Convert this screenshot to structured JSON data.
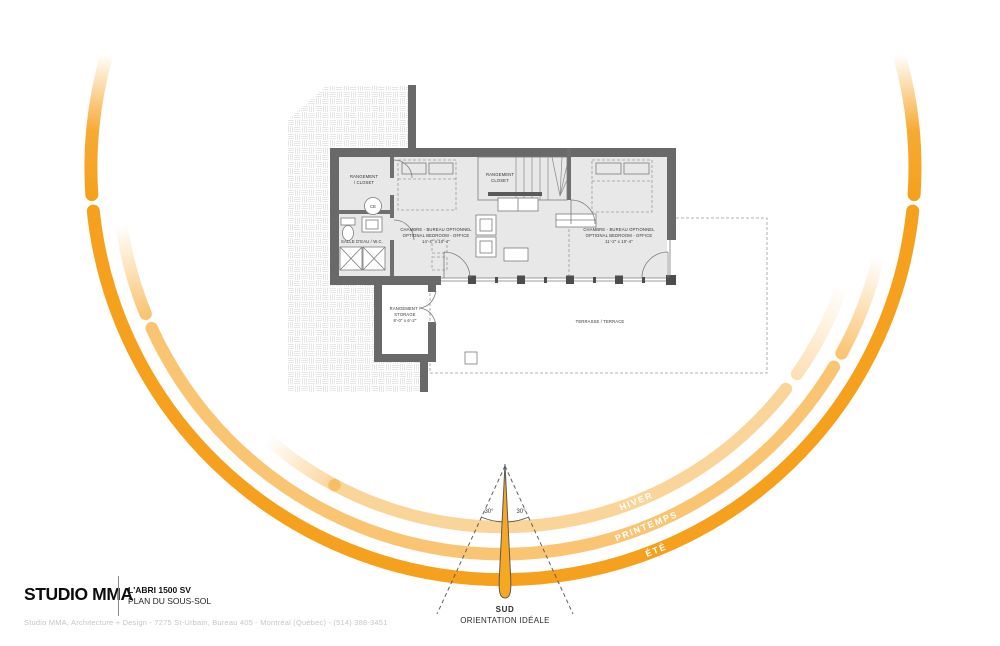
{
  "title_block": {
    "logo": "STUDIO MMA",
    "project": "L'ABRI 1500 SV",
    "sheet": "PLAN DU SOUS-SOL"
  },
  "footer_text": "Studio MMA, Architecture + Design - 7275 St-Urbain, Bureau 405 - Montréal (Québec) - (514) 388-3451",
  "compass": {
    "cardinal": "SUD",
    "caption": "ORIENTATION IDÉALE",
    "angle_left": "30°",
    "angle_right": "30°"
  },
  "sun_paths": {
    "winter": "HIVER",
    "spring": "PRINTEMPS",
    "summer": "ÉTÉ",
    "accent_color": "#F5A11D"
  },
  "plan": {
    "closet_upper": {
      "lines": [
        "RANGEMENT",
        "/ CLOSET"
      ]
    },
    "water_heater": "CE",
    "bathroom": "SALLE D'EAU / W.C.",
    "bedroom_left": {
      "lines": [
        "CHAMBRE - BUREAU OPTIONNEL",
        "OPTIONAL BEDROOM - OFFICE",
        "14'-4\" x 10'-4\""
      ]
    },
    "stair_closet": {
      "lines": [
        "RANGEMENT",
        "CLOSET"
      ]
    },
    "bedroom_right": {
      "lines": [
        "CHAMBRE - BUREAU OPTIONNEL",
        "OPTIONAL BEDROOM - OFFICE",
        "11'-2\" x 10'-4\""
      ]
    },
    "storage": {
      "lines": [
        "RANGEMENT /",
        "STORAGE",
        "8'-0\" x 6'-2\""
      ]
    },
    "terrace": "TERRASSE / TERRACE"
  },
  "colors": {
    "accent": "#F5A11D",
    "wall": "#696969",
    "floor": "#E8E8E8"
  }
}
